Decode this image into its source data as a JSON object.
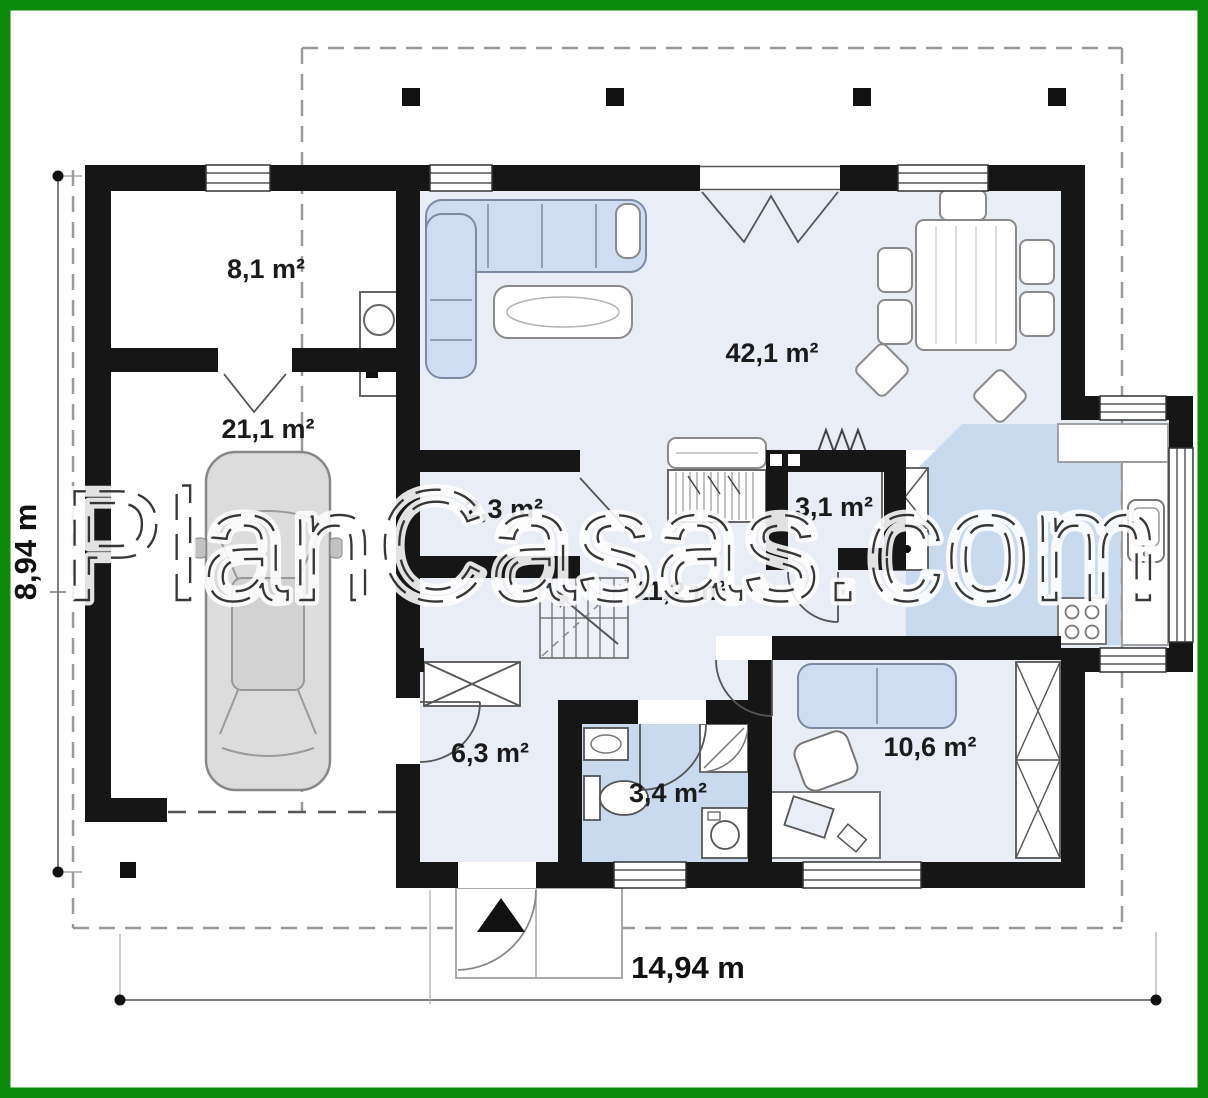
{
  "watermark": {
    "text": "PlanCasas.com"
  },
  "dimensions": {
    "left": "8,94 m",
    "bottom": "14,94 m"
  },
  "rooms": [
    {
      "id": "storage",
      "label": "8,1 m²"
    },
    {
      "id": "garage",
      "label": "21,1 m²"
    },
    {
      "id": "living-room-kitchen",
      "label": "42,1 m²"
    },
    {
      "id": "closet",
      "label": "2,3 m²"
    },
    {
      "id": "pantry",
      "label": "3,1 m²"
    },
    {
      "id": "hall",
      "label": "11,2 m²"
    },
    {
      "id": "entry-hall",
      "label": "6,3 m²"
    },
    {
      "id": "bathroom",
      "label": "3,4 m²"
    },
    {
      "id": "office-room",
      "label": "10,6 m²"
    }
  ],
  "colors": {
    "border_green": "#0c8a0c",
    "wall_black": "#161616",
    "floor_light_blue": "#e9edf6",
    "floor_wet_blue": "#c9d9ee",
    "furniture_blue": "#cfdcf2",
    "line_gray": "#8a8a8a"
  }
}
